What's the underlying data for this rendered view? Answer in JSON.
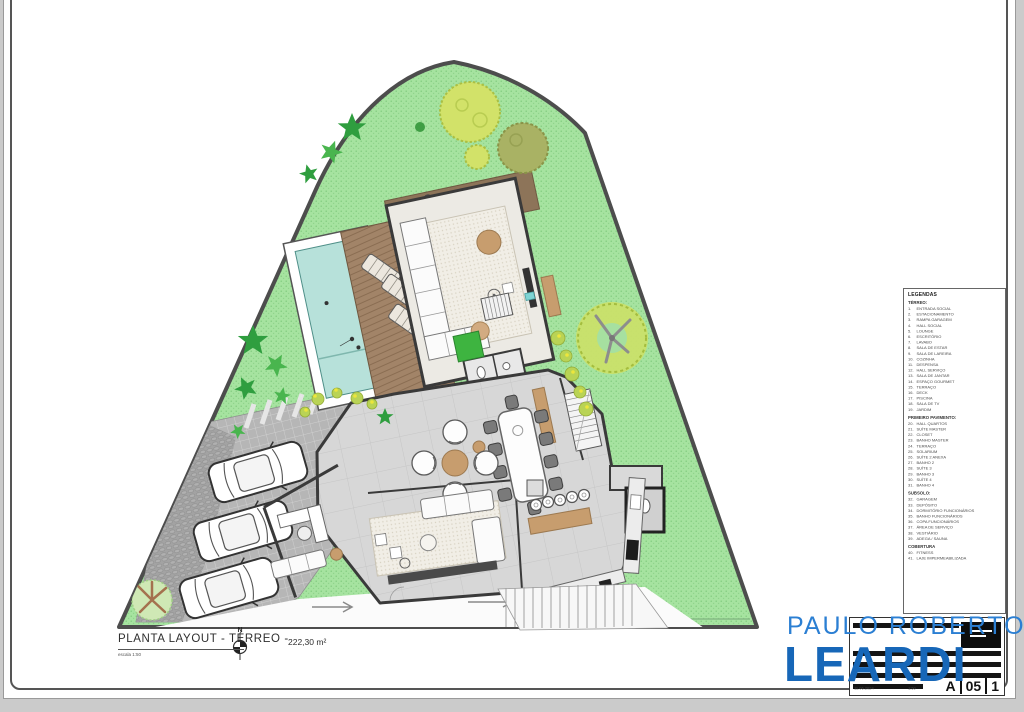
{
  "sheet": {
    "title": "PLANTA LAYOUT -  TÉRREO  -",
    "area": "222,30 m²",
    "scale_note": "escala 1:50",
    "north_label": "N"
  },
  "legend": {
    "title": "LEGENDAS",
    "sections": [
      {
        "header": "TÉRREO:",
        "items": [
          "ENTRADA SOCIAL",
          "ESTACIONAMENTO",
          "RAMPA GARAGEM",
          "HALL SOCIAL",
          "LOUNGE",
          "ESCRITÓRIO",
          "LAVABO",
          "SALA DE ESTAR",
          "SALA DE LAREIRA",
          "COZINHA",
          "DESPENSA",
          "HALL SERVIÇO",
          "SALA DE JANTAR",
          "ESPAÇO GOURMET",
          "TERRAÇO",
          "DECK",
          "PISCINA",
          "SALA DE TV",
          "JARDIM"
        ]
      },
      {
        "header": "PRIMEIRO PAVIMENTO:",
        "items": [
          "HALL QUARTOS",
          "SUÍTE MASTER",
          "CLOSET",
          "BANHO MASTER",
          "TERRAÇO",
          "SOLARIUM",
          "SUÍTE 2 ANEXA",
          "BANHO 2",
          "SUÍTE 3",
          "BANHO 3",
          "SUÍTE 4",
          "BANHO 4"
        ]
      },
      {
        "header": "SUBSOLO:",
        "items": [
          "GARAGEM",
          "DEPÓSITO",
          "DORMITÓRIO FUNCIONÁRIOS",
          "BANHO FUNCIONÁRIOS",
          "COPA FUNCIONÁRIOS",
          "ÁREA DE SERVIÇO",
          "VESTIÁRIO",
          "ADEGA / SAUNA"
        ]
      },
      {
        "header": "COBERTURA",
        "items": [
          "FITNESS",
          "LAJE IMPERMEABILIZADA"
        ]
      }
    ]
  },
  "brand": {
    "line1": "PAULO ROBERTO",
    "line2": "LEARDI",
    "color_light": "#2b7fd3",
    "color_bold": "#1767b8"
  },
  "titleblock": {
    "date": "11.06.2024",
    "scale": "1:50",
    "code": [
      "A",
      "05",
      "1"
    ]
  }
}
